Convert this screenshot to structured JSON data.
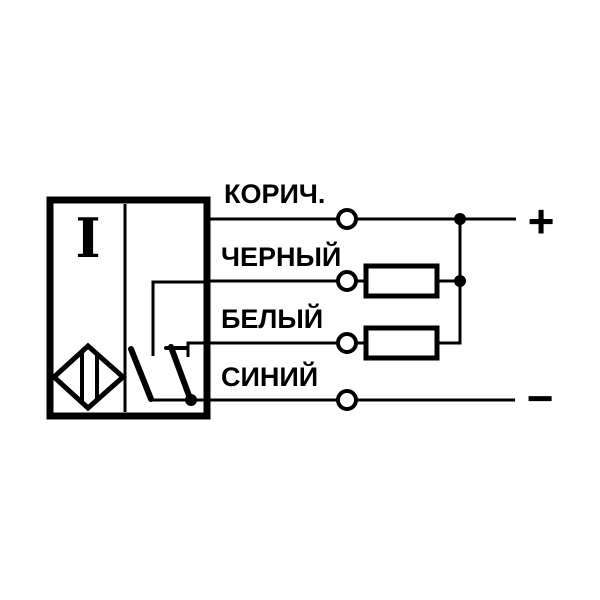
{
  "page": {
    "background": "#ffffff",
    "line_color": "#000000"
  },
  "diagram": {
    "kind": "sensor-wiring-diagram",
    "sensor": {
      "marking": "I"
    },
    "wires": [
      {
        "label": "КОРИЧ."
      },
      {
        "label": "ЧЕРНЫЙ"
      },
      {
        "label": "БЕЛЫЙ"
      },
      {
        "label": "СИНИЙ"
      }
    ],
    "terminals": {
      "positive": "+",
      "negative": "−"
    }
  }
}
